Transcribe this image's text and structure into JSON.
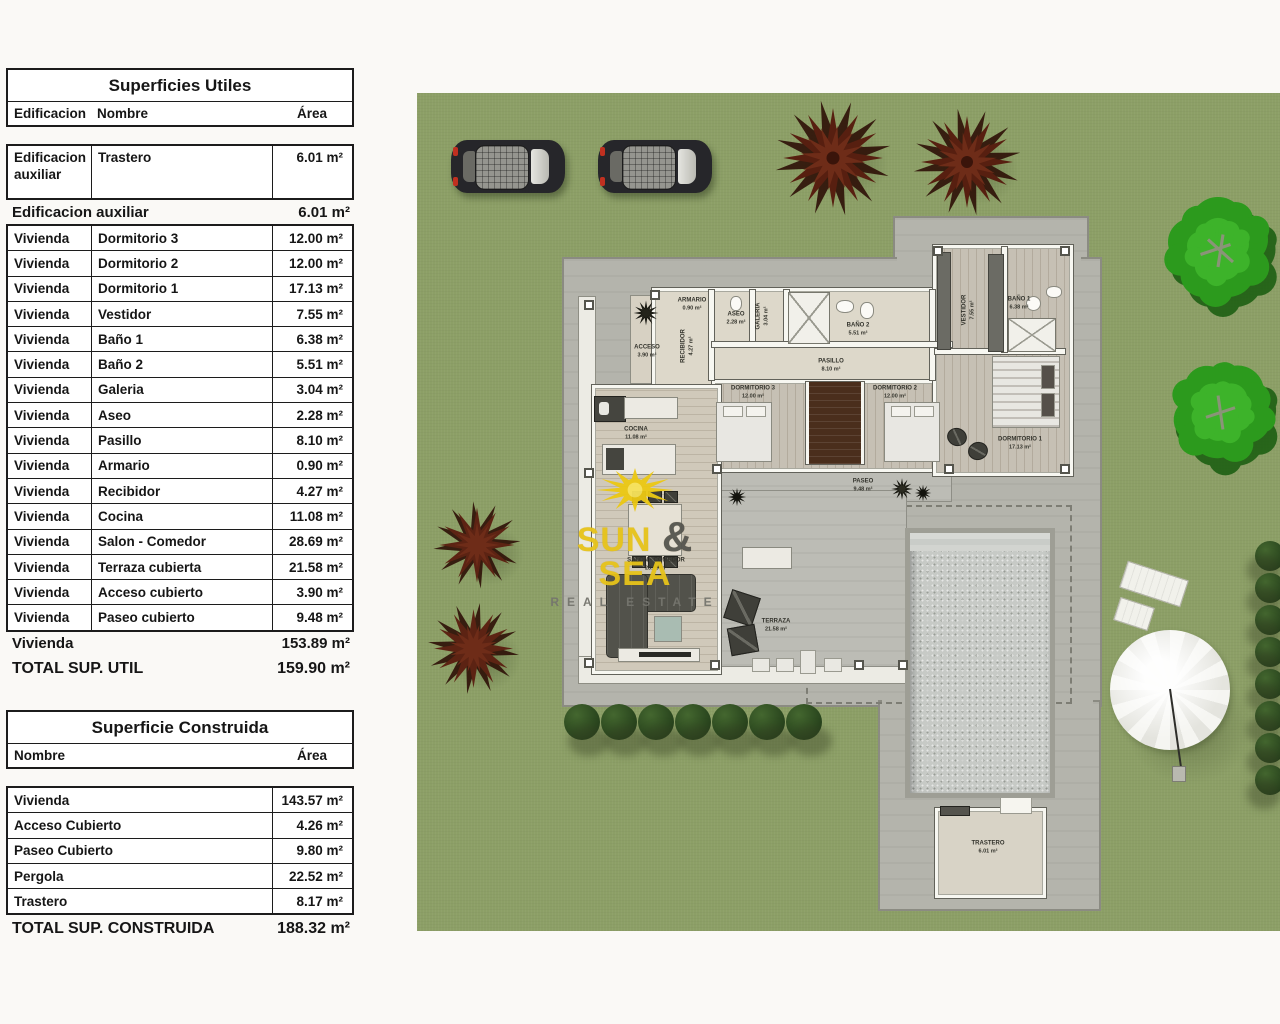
{
  "tables": {
    "utiles": {
      "title": "Superficies Utiles",
      "headers": {
        "edificacion": "Edificacion",
        "nombre": "Nombre",
        "area": "Área"
      },
      "first_row": {
        "edificacion": "Edificacion auxiliar",
        "nombre": "Trastero",
        "area": "6.01 m²"
      },
      "subtotal_aux": {
        "label": "Edificacion auxiliar",
        "area": "6.01 m²"
      },
      "rows": [
        {
          "edificacion": "Vivienda",
          "nombre": "Dormitorio 3",
          "area": "12.00 m²"
        },
        {
          "edificacion": "Vivienda",
          "nombre": "Dormitorio 2",
          "area": "12.00 m²"
        },
        {
          "edificacion": "Vivienda",
          "nombre": "Dormitorio 1",
          "area": "17.13 m²"
        },
        {
          "edificacion": "Vivienda",
          "nombre": "Vestidor",
          "area": "7.55 m²"
        },
        {
          "edificacion": "Vivienda",
          "nombre": "Baño 1",
          "area": "6.38 m²"
        },
        {
          "edificacion": "Vivienda",
          "nombre": "Baño 2",
          "area": "5.51 m²"
        },
        {
          "edificacion": "Vivienda",
          "nombre": "Galeria",
          "area": "3.04 m²"
        },
        {
          "edificacion": "Vivienda",
          "nombre": "Aseo",
          "area": "2.28 m²"
        },
        {
          "edificacion": "Vivienda",
          "nombre": "Pasillo",
          "area": "8.10 m²"
        },
        {
          "edificacion": "Vivienda",
          "nombre": "Armario",
          "area": "0.90 m²"
        },
        {
          "edificacion": "Vivienda",
          "nombre": "Recibidor",
          "area": "4.27 m²"
        },
        {
          "edificacion": "Vivienda",
          "nombre": "Cocina",
          "area": "11.08 m²"
        },
        {
          "edificacion": "Vivienda",
          "nombre": "Salon - Comedor",
          "area": "28.69 m²"
        },
        {
          "edificacion": "Vivienda",
          "nombre": "Terraza cubierta",
          "area": "21.58 m²"
        },
        {
          "edificacion": "Vivienda",
          "nombre": "Acceso cubierto",
          "area": "3.90 m²"
        },
        {
          "edificacion": "Vivienda",
          "nombre": "Paseo cubierto",
          "area": "9.48 m²"
        }
      ],
      "subtotal_vivienda": {
        "label": "Vivienda",
        "area": "153.89 m²"
      },
      "total": {
        "label": "TOTAL SUP. UTIL",
        "area": "159.90 m²"
      }
    },
    "construida": {
      "title": "Superficie Construida",
      "headers": {
        "nombre": "Nombre",
        "area": "Área"
      },
      "rows": [
        {
          "nombre": "Vivienda",
          "area": "143.57 m²"
        },
        {
          "nombre": "Acceso Cubierto",
          "area": "4.26 m²"
        },
        {
          "nombre": "Paseo Cubierto",
          "area": "9.80 m²"
        },
        {
          "nombre": "Pergola",
          "area": "22.52 m²"
        },
        {
          "nombre": "Trastero",
          "area": "8.17 m²"
        }
      ],
      "total": {
        "label": "TOTAL SUP. CONSTRUIDA",
        "area": "188.32 m²"
      }
    }
  },
  "plan": {
    "rooms": {
      "armario": {
        "name": "ARMARIO",
        "area": "0.90 m²"
      },
      "aseo": {
        "name": "ASEO",
        "area": "2.28 m²"
      },
      "galeria": {
        "name": "GALERIA",
        "area": "3.04 m²"
      },
      "bano2": {
        "name": "BAÑO 2",
        "area": "5.51 m²"
      },
      "acceso": {
        "name": "ACCESO",
        "area": "3.90 m²"
      },
      "recibidor": {
        "name": "RECIBIDOR",
        "area": "4.27 m²"
      },
      "pasillo": {
        "name": "PASILLO",
        "area": "8.10 m²"
      },
      "dorm3": {
        "name": "DORMITORIO 3",
        "area": "12.00 m²"
      },
      "dorm2": {
        "name": "DORMITORIO 2",
        "area": "12.00 m²"
      },
      "vestidor": {
        "name": "VESTIDOR",
        "area": "7.55 m²"
      },
      "bano1": {
        "name": "BAÑO 1",
        "area": "6.38 m²"
      },
      "dorm1": {
        "name": "DORMITORIO 1",
        "area": "17.13 m²"
      },
      "cocina": {
        "name": "COCINA",
        "area": "11.08 m²"
      },
      "salon": {
        "name": "SALON - COMEDOR",
        "area": "28.69 m²"
      },
      "terraza": {
        "name": "TERRAZA",
        "area": "21.58 m²"
      },
      "paseo": {
        "name": "PASEO",
        "area": "9.48 m²"
      },
      "trastero": {
        "name": "TRASTERO",
        "area": "6.01 m²"
      }
    },
    "logo": {
      "word1": "SUN",
      "amp": "&",
      "word2": "SEA",
      "subtitle": "REAL ESTATE"
    }
  },
  "colors": {
    "brand_yellow": "#e7c31a",
    "brand_gray": "#75756e",
    "grass_green": "#8c9f66",
    "pavement_gray": "#b4b4ac"
  }
}
